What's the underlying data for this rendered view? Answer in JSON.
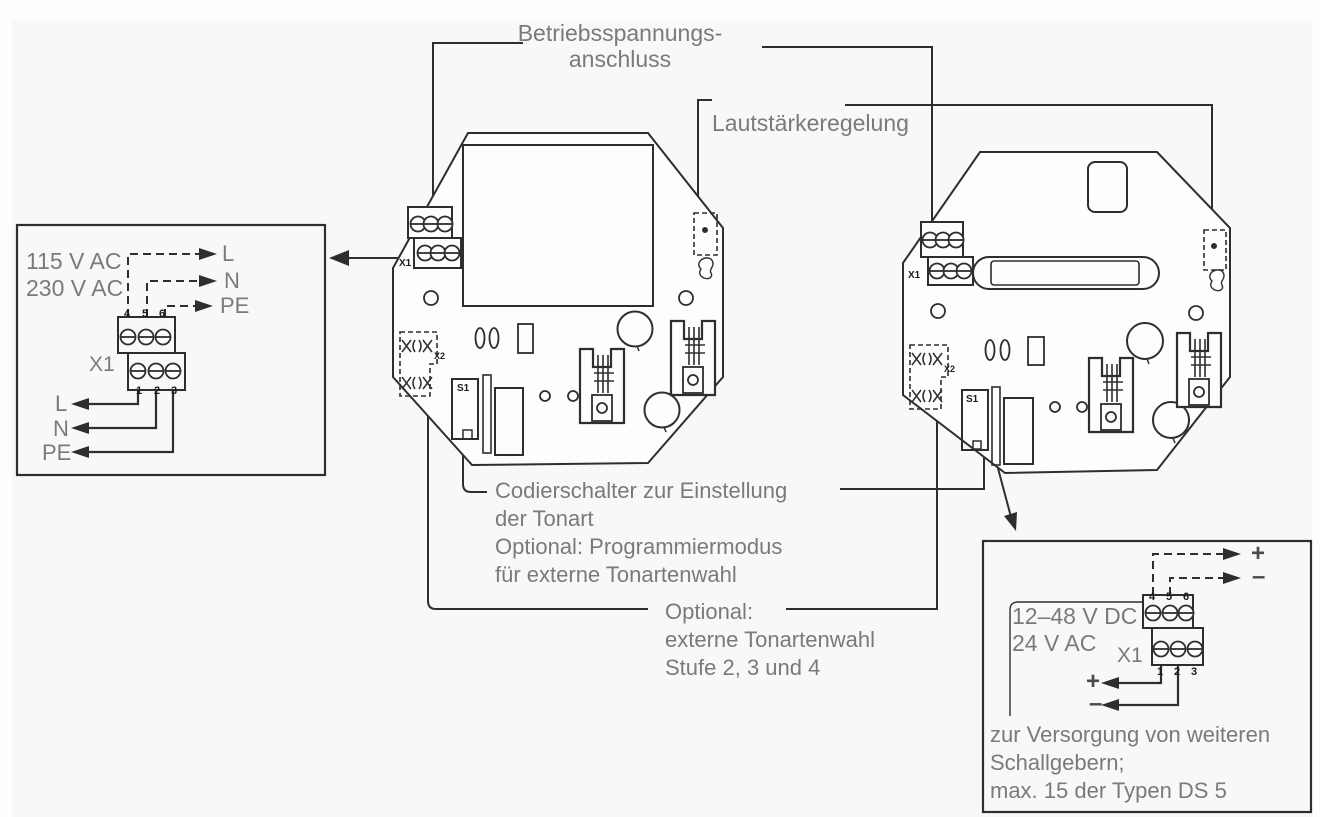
{
  "title_labels": {
    "power_line1": "Betriebsspannungs-",
    "power_line2": "anschluss",
    "volume": "Lautstärkeregelung",
    "coding_line1": "Codierschalter zur Einstellung",
    "coding_line2": "der Tonart",
    "coding_line3": "Optional: Programmiermodus",
    "coding_line4": "für externe Tonartenwahl",
    "optional_line1": "Optional:",
    "optional_line2": "externe Tonartenwahl",
    "optional_line3": "Stufe 2, 3 und 4"
  },
  "left_supply_box": {
    "voltage1": "115 V AC",
    "voltage2": "230 V AC",
    "terminal_label": "X1",
    "pins_top": [
      "4",
      "5",
      "6"
    ],
    "pins_bottom": [
      "1",
      "2",
      "3"
    ],
    "wires_top": [
      "L",
      "N",
      "PE"
    ],
    "wires_bottom": [
      "L",
      "N",
      "PE"
    ]
  },
  "right_supply_box": {
    "voltage1": "12–48 V DC",
    "voltage2": "24 V AC",
    "terminal_label": "X1",
    "pins_top": [
      "4",
      "5",
      "6"
    ],
    "pins_bottom": [
      "1",
      "2",
      "3"
    ],
    "wires_top": [
      "+",
      "–"
    ],
    "wires_bottom": [
      "+",
      "–"
    ],
    "note1": "zur Versorgung von weiteren",
    "note2": "Schallgebern;",
    "note3": "max. 15 der Typen DS 5"
  },
  "pcb_left": {
    "x1": "X1",
    "x2": "X2",
    "s1": "S1"
  },
  "pcb_right": {
    "x1": "X1",
    "x2": "X2",
    "s1": "S1"
  },
  "colors": {
    "line": "#2e2e2e",
    "label": "#7a7a7a",
    "background": "#fdfdfd"
  }
}
